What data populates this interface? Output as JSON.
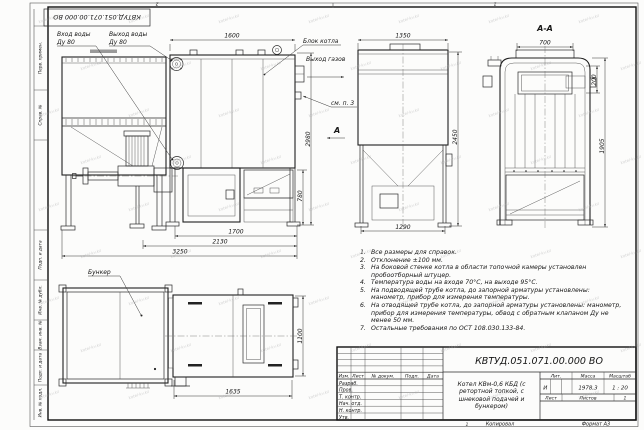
{
  "frame": {
    "stamp_top_inverted": "КВТУД.051.071.00.000 ВО",
    "left_labels": [
      "Перв. примен.",
      "Справ. №",
      "Подп. и дата",
      "Инв. № дубл.",
      "Взам. инв. №",
      "Подп. и дата",
      "Инв. № подл."
    ],
    "zone_top_left": "2",
    "zone_top_right": "1",
    "zone_bottom": "1"
  },
  "views": {
    "front": {
      "water_inlet_label": "Вход воды",
      "water_inlet_dn": "Ду 80",
      "water_outlet_label": "Выход воды",
      "water_outlet_dn": "Ду 80",
      "boiler_block_label": "Блок котла",
      "gas_outlet_label": "Выход газов",
      "see_note_label": "см. п. 3",
      "section_arrow_label": "А",
      "dim_width_boiler": "1600",
      "dim_height_total": "2980",
      "dim_height_furnace": "780",
      "dim_bottom_1700": "1700",
      "dim_bottom_2130": "2130",
      "dim_bottom_3250": "3250"
    },
    "side": {
      "dim_width": "1350",
      "dim_height": "2450",
      "dim_bottom": "1290"
    },
    "section_aa": {
      "title": "А-А",
      "dim_top": "700",
      "dim_window": "200",
      "dim_height": "1905"
    },
    "plan": {
      "bunker_label": "Бункер",
      "dim_length": "1635",
      "dim_width": "1100"
    }
  },
  "notes": {
    "items": [
      {
        "num": "1.",
        "text": "Все размеры для справок."
      },
      {
        "num": "2.",
        "text": "Отклонение ±100 мм."
      },
      {
        "num": "3.",
        "text": "На боковой стенке котла в области топочной камеры установлен пробоотборный штуцер."
      },
      {
        "num": "4.",
        "text": "Температура воды на входе 70°С, на выходе 95°С."
      },
      {
        "num": "5.",
        "text": "На подводящей трубе котла, до запорной арматуры установлены: манометр, прибор для измерения температуры."
      },
      {
        "num": "6.",
        "text": "На отводящей трубе котла, до запорной арматуры установлены: манометр, прибор для измерения температуры, обвод с обратным клапаном Ду не менее 50 мм."
      },
      {
        "num": "7.",
        "text": "Остальные требования по ОСТ 108.030.133-84."
      }
    ]
  },
  "title_block": {
    "doc_code": "КВТУД.051.071.00.000 ВО",
    "product_name": "Котел КВм-0,6 КБД (с ретортной топкой, с шнековой подачей и бункером)",
    "col_izm": "Изм.",
    "col_list": "Лист",
    "col_doc": "№ докум.",
    "col_podp": "Подп.",
    "col_data": "Дата",
    "row_labels": [
      "Разраб.",
      "Пров.",
      "Т. контр.",
      "Нач. отд.",
      "Н. контр.",
      "Утв."
    ],
    "lit_header": "Лит.",
    "mass_header": "Масса",
    "scale_header": "Масштаб",
    "lit_value": "И",
    "mass_value": "1978,3",
    "scale_value": "1 : 20",
    "sheet_label": "Лист",
    "sheets_label": "Листов",
    "sheets_value": "1",
    "copied_label": "Копировал",
    "format_label": "Формат А3"
  },
  "watermark": {
    "text": "kotel-kv.kz"
  }
}
